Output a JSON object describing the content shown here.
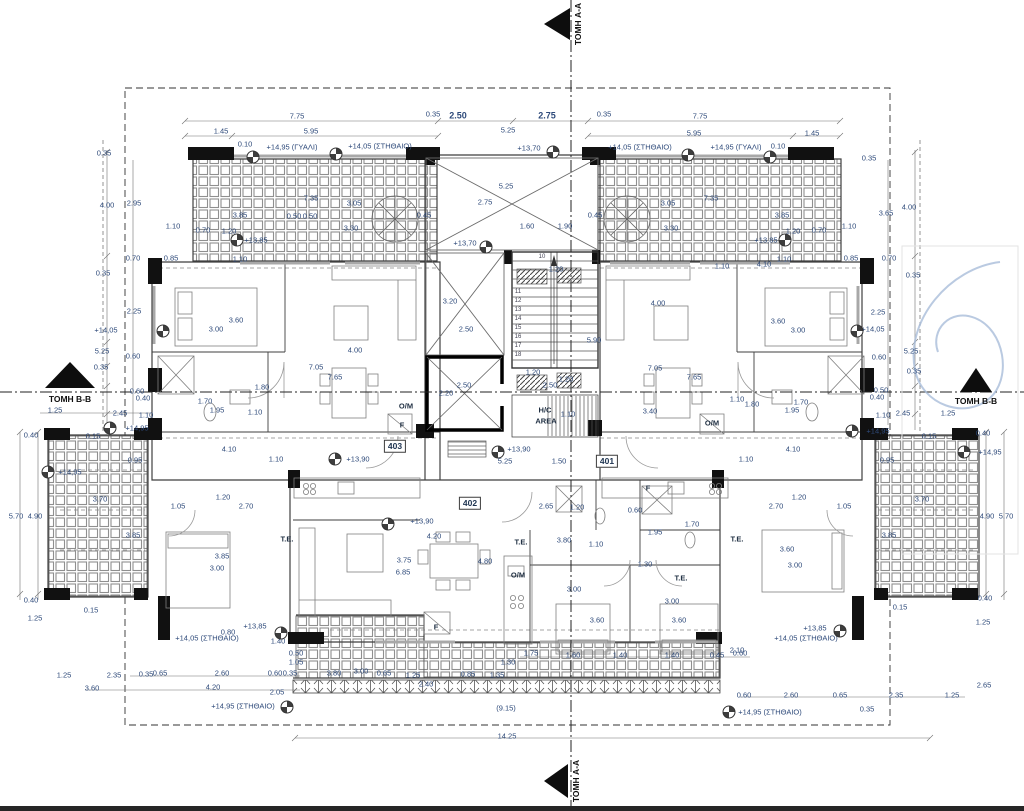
{
  "section_markers": {
    "top": "ΤΟΜΗ A-A",
    "bottom": "ΤΟΜΗ A-A",
    "left": "ΤΟΜΗ B-B",
    "right": "ΤΟΜΗ B-B"
  },
  "apartment_numbers": [
    {
      "t": "403",
      "x": 395,
      "y": 446
    },
    {
      "t": "401",
      "x": 607,
      "y": 461
    },
    {
      "t": "402",
      "x": 470,
      "y": 503
    }
  ],
  "room_labels": [
    {
      "t": "O/M",
      "x": 406,
      "y": 406
    },
    {
      "t": "F",
      "x": 402,
      "y": 425
    },
    {
      "t": "O/M",
      "x": 712,
      "y": 423
    },
    {
      "t": "F",
      "x": 648,
      "y": 488
    },
    {
      "t": "O/M",
      "x": 518,
      "y": 575
    },
    {
      "t": "F",
      "x": 436,
      "y": 627
    },
    {
      "t": "T.E.",
      "x": 287,
      "y": 539
    },
    {
      "t": "T.E.",
      "x": 521,
      "y": 542
    },
    {
      "t": "T.E.",
      "x": 681,
      "y": 578
    },
    {
      "t": "T.E.",
      "x": 737,
      "y": 539
    },
    {
      "t": "H/C",
      "x": 545,
      "y": 410
    },
    {
      "t": "AREA",
      "x": 546,
      "y": 421
    }
  ],
  "stair_step_numbers": [
    {
      "t": "10",
      "x": 542,
      "y": 257
    },
    {
      "t": "11",
      "x": 518,
      "y": 292
    },
    {
      "t": "12",
      "x": 518,
      "y": 301
    },
    {
      "t": "13",
      "x": 518,
      "y": 310
    },
    {
      "t": "14",
      "x": 518,
      "y": 319
    },
    {
      "t": "15",
      "x": 518,
      "y": 328
    },
    {
      "t": "16",
      "x": 518,
      "y": 337
    },
    {
      "t": "17",
      "x": 518,
      "y": 346
    },
    {
      "t": "18",
      "x": 518,
      "y": 355
    }
  ],
  "elevation_marks": [
    {
      "t": "+14,95 (ΓΥΑΛΙ)",
      "x": 292,
      "y": 147
    },
    {
      "t": "+14,05 (ΣΤΗΘΑΙΟ)",
      "x": 380,
      "y": 146
    },
    {
      "t": "+14,05 (ΣΤΗΘΑΙΟ)",
      "x": 640,
      "y": 147
    },
    {
      "t": "+14,95 (ΓΥΑΛΙ)",
      "x": 736,
      "y": 147
    },
    {
      "t": "+13,70",
      "x": 529,
      "y": 148
    },
    {
      "t": "+13,70",
      "x": 465,
      "y": 243
    },
    {
      "t": "+13,85",
      "x": 256,
      "y": 240
    },
    {
      "t": "+13,85",
      "x": 766,
      "y": 240
    },
    {
      "t": "+14,05",
      "x": 106,
      "y": 330
    },
    {
      "t": "+14,05",
      "x": 873,
      "y": 329
    },
    {
      "t": "+14,95",
      "x": 137,
      "y": 428
    },
    {
      "t": "+14,95",
      "x": 878,
      "y": 431
    },
    {
      "t": "+14,95",
      "x": 70,
      "y": 472
    },
    {
      "t": "+14,95",
      "x": 990,
      "y": 452
    },
    {
      "t": "+13,90",
      "x": 358,
      "y": 459
    },
    {
      "t": "+13,90",
      "x": 519,
      "y": 449
    },
    {
      "t": "+13,90",
      "x": 422,
      "y": 521
    },
    {
      "t": "+13,85",
      "x": 255,
      "y": 626
    },
    {
      "t": "+14,05 (ΣΤΗΘΑΙΟ)",
      "x": 207,
      "y": 638
    },
    {
      "t": "+13,85",
      "x": 815,
      "y": 628
    },
    {
      "t": "+14,05 (ΣΤΗΘΑΙΟ)",
      "x": 806,
      "y": 638
    },
    {
      "t": "+14,95 (ΣΤΗΘΑΙΟ)",
      "x": 243,
      "y": 706
    },
    {
      "t": "+14,95 (ΣΤΗΘΑΙΟ)",
      "x": 770,
      "y": 712
    }
  ],
  "elevation_symbols": [
    {
      "x": 253,
      "y": 157
    },
    {
      "x": 336,
      "y": 154
    },
    {
      "x": 688,
      "y": 155
    },
    {
      "x": 770,
      "y": 157
    },
    {
      "x": 553,
      "y": 152
    },
    {
      "x": 486,
      "y": 247
    },
    {
      "x": 237,
      "y": 240
    },
    {
      "x": 785,
      "y": 240
    },
    {
      "x": 163,
      "y": 331
    },
    {
      "x": 857,
      "y": 331
    },
    {
      "x": 110,
      "y": 428
    },
    {
      "x": 852,
      "y": 431
    },
    {
      "x": 48,
      "y": 472
    },
    {
      "x": 964,
      "y": 452
    },
    {
      "x": 335,
      "y": 459
    },
    {
      "x": 498,
      "y": 452
    },
    {
      "x": 388,
      "y": 524
    },
    {
      "x": 281,
      "y": 633
    },
    {
      "x": 840,
      "y": 631
    },
    {
      "x": 287,
      "y": 707
    },
    {
      "x": 729,
      "y": 712
    }
  ],
  "dimensions": [
    {
      "t": "7.75",
      "x": 297,
      "y": 116
    },
    {
      "t": "1.45",
      "x": 221,
      "y": 131
    },
    {
      "t": "5.95",
      "x": 311,
      "y": 131
    },
    {
      "t": "0.10",
      "x": 245,
      "y": 144
    },
    {
      "t": "0.35",
      "x": 433,
      "y": 114
    },
    {
      "t": "2.50",
      "x": 458,
      "y": 116,
      "b": 1
    },
    {
      "t": "2.75",
      "x": 547,
      "y": 116,
      "b": 1
    },
    {
      "t": "0.35",
      "x": 604,
      "y": 114
    },
    {
      "t": "5.25",
      "x": 508,
      "y": 130
    },
    {
      "t": "7.75",
      "x": 700,
      "y": 116
    },
    {
      "t": "5.95",
      "x": 694,
      "y": 133
    },
    {
      "t": "1.45",
      "x": 812,
      "y": 133
    },
    {
      "t": "0.10",
      "x": 778,
      "y": 146
    },
    {
      "t": "5.25",
      "x": 506,
      "y": 186
    },
    {
      "t": "2.75",
      "x": 485,
      "y": 202
    },
    {
      "t": "1.60",
      "x": 527,
      "y": 226
    },
    {
      "t": "1.90",
      "x": 565,
      "y": 226
    },
    {
      "t": "0.45",
      "x": 424,
      "y": 215
    },
    {
      "t": "0.45",
      "x": 595,
      "y": 215
    },
    {
      "t": "7.35",
      "x": 311,
      "y": 198
    },
    {
      "t": "3.05",
      "x": 354,
      "y": 203
    },
    {
      "t": "3.85",
      "x": 240,
      "y": 215
    },
    {
      "t": "0.50",
      "x": 294,
      "y": 216
    },
    {
      "t": "0.50",
      "x": 310,
      "y": 216
    },
    {
      "t": "3.30",
      "x": 351,
      "y": 228
    },
    {
      "t": "0.70",
      "x": 203,
      "y": 230
    },
    {
      "t": "1.20",
      "x": 229,
      "y": 231
    },
    {
      "t": "1.10",
      "x": 240,
      "y": 259
    },
    {
      "t": "7.35",
      "x": 711,
      "y": 198
    },
    {
      "t": "3.05",
      "x": 668,
      "y": 203
    },
    {
      "t": "3.85",
      "x": 782,
      "y": 215
    },
    {
      "t": "3.30",
      "x": 671,
      "y": 228
    },
    {
      "t": "0.70",
      "x": 819,
      "y": 230
    },
    {
      "t": "1.20",
      "x": 793,
      "y": 231
    },
    {
      "t": "1.10",
      "x": 784,
      "y": 259
    },
    {
      "t": "0.35",
      "x": 104,
      "y": 153
    },
    {
      "t": "4.00",
      "x": 107,
      "y": 205
    },
    {
      "t": "2.95",
      "x": 134,
      "y": 203
    },
    {
      "t": "1.10",
      "x": 173,
      "y": 226
    },
    {
      "t": "0.70",
      "x": 133,
      "y": 258
    },
    {
      "t": "0.85",
      "x": 171,
      "y": 258
    },
    {
      "t": "0.35",
      "x": 103,
      "y": 273
    },
    {
      "t": "2.25",
      "x": 134,
      "y": 311
    },
    {
      "t": "5.25",
      "x": 102,
      "y": 351
    },
    {
      "t": "0.60",
      "x": 133,
      "y": 356
    },
    {
      "t": "0.35",
      "x": 101,
      "y": 367
    },
    {
      "t": "0.60",
      "x": 137,
      "y": 391
    },
    {
      "t": "0.40",
      "x": 143,
      "y": 398
    },
    {
      "t": "1.25",
      "x": 55,
      "y": 410
    },
    {
      "t": "2.45",
      "x": 120,
      "y": 413
    },
    {
      "t": "1.10",
      "x": 146,
      "y": 415
    },
    {
      "t": "0.35",
      "x": 869,
      "y": 158
    },
    {
      "t": "4.00",
      "x": 909,
      "y": 207
    },
    {
      "t": "3.65",
      "x": 886,
      "y": 213
    },
    {
      "t": "1.10",
      "x": 849,
      "y": 226
    },
    {
      "t": "0.85",
      "x": 851,
      "y": 258
    },
    {
      "t": "0.70",
      "x": 889,
      "y": 258
    },
    {
      "t": "0.35",
      "x": 913,
      "y": 275
    },
    {
      "t": "2.25",
      "x": 878,
      "y": 312
    },
    {
      "t": "5.25",
      "x": 911,
      "y": 351
    },
    {
      "t": "0.60",
      "x": 879,
      "y": 357
    },
    {
      "t": "0.35",
      "x": 914,
      "y": 371
    },
    {
      "t": "0.50",
      "x": 881,
      "y": 390
    },
    {
      "t": "0.40",
      "x": 877,
      "y": 397
    },
    {
      "t": "2.45",
      "x": 903,
      "y": 413
    },
    {
      "t": "1.10",
      "x": 883,
      "y": 415
    },
    {
      "t": "1.25",
      "x": 948,
      "y": 413
    },
    {
      "t": "3.60",
      "x": 236,
      "y": 320
    },
    {
      "t": "3.00",
      "x": 216,
      "y": 329
    },
    {
      "t": "1.80",
      "x": 262,
      "y": 387
    },
    {
      "t": "1.70",
      "x": 205,
      "y": 401
    },
    {
      "t": "1.95",
      "x": 217,
      "y": 410
    },
    {
      "t": "1.10",
      "x": 255,
      "y": 412
    },
    {
      "t": "4.00",
      "x": 355,
      "y": 350
    },
    {
      "t": "7.05",
      "x": 316,
      "y": 367
    },
    {
      "t": "7.65",
      "x": 335,
      "y": 377
    },
    {
      "t": "4.10",
      "x": 229,
      "y": 449
    },
    {
      "t": "1.10",
      "x": 276,
      "y": 459
    },
    {
      "t": "1.20",
      "x": 223,
      "y": 497
    },
    {
      "t": "1.05",
      "x": 178,
      "y": 506
    },
    {
      "t": "2.70",
      "x": 246,
      "y": 506
    },
    {
      "t": "3.85",
      "x": 222,
      "y": 556
    },
    {
      "t": "3.00",
      "x": 217,
      "y": 568
    },
    {
      "t": "3.60",
      "x": 778,
      "y": 321
    },
    {
      "t": "3.00",
      "x": 798,
      "y": 330
    },
    {
      "t": "4.00",
      "x": 658,
      "y": 303
    },
    {
      "t": "7.05",
      "x": 655,
      "y": 368
    },
    {
      "t": "7.65",
      "x": 694,
      "y": 377
    },
    {
      "t": "3.40",
      "x": 650,
      "y": 411
    },
    {
      "t": "1.10",
      "x": 737,
      "y": 399
    },
    {
      "t": "1.80",
      "x": 752,
      "y": 404
    },
    {
      "t": "1.70",
      "x": 801,
      "y": 402
    },
    {
      "t": "1.95",
      "x": 792,
      "y": 410
    },
    {
      "t": "4.10",
      "x": 793,
      "y": 449
    },
    {
      "t": "1.10",
      "x": 746,
      "y": 459
    },
    {
      "t": "1.20",
      "x": 799,
      "y": 497
    },
    {
      "t": "1.05",
      "x": 844,
      "y": 506
    },
    {
      "t": "2.70",
      "x": 776,
      "y": 506
    },
    {
      "t": "3.60",
      "x": 787,
      "y": 549
    },
    {
      "t": "3.00",
      "x": 795,
      "y": 565
    },
    {
      "t": "1.10",
      "x": 722,
      "y": 266
    },
    {
      "t": "4.10",
      "x": 764,
      "y": 264
    },
    {
      "t": "3.20",
      "x": 450,
      "y": 301
    },
    {
      "t": "2.50",
      "x": 466,
      "y": 329
    },
    {
      "t": "2.50",
      "x": 464,
      "y": 385
    },
    {
      "t": "2.20",
      "x": 446,
      "y": 393
    },
    {
      "t": "1.20",
      "x": 556,
      "y": 269
    },
    {
      "t": "1.20",
      "x": 533,
      "y": 372
    },
    {
      "t": "1.20",
      "x": 566,
      "y": 379
    },
    {
      "t": "5.90",
      "x": 594,
      "y": 340
    },
    {
      "t": "2.50",
      "x": 550,
      "y": 385
    },
    {
      "t": "1.10",
      "x": 568,
      "y": 414
    },
    {
      "t": "5.25",
      "x": 505,
      "y": 461
    },
    {
      "t": "1.50",
      "x": 559,
      "y": 461
    },
    {
      "t": "2.65",
      "x": 546,
      "y": 506
    },
    {
      "t": "1.20",
      "x": 577,
      "y": 507
    },
    {
      "t": "0.60",
      "x": 635,
      "y": 510
    },
    {
      "t": "1.70",
      "x": 692,
      "y": 524
    },
    {
      "t": "1.95",
      "x": 655,
      "y": 532
    },
    {
      "t": "3.80",
      "x": 564,
      "y": 540
    },
    {
      "t": "1.10",
      "x": 596,
      "y": 544
    },
    {
      "t": "1.30",
      "x": 645,
      "y": 564
    },
    {
      "t": "3.00",
      "x": 574,
      "y": 589
    },
    {
      "t": "3.00",
      "x": 672,
      "y": 601
    },
    {
      "t": "3.60",
      "x": 597,
      "y": 620
    },
    {
      "t": "3.60",
      "x": 679,
      "y": 620
    },
    {
      "t": "4.20",
      "x": 434,
      "y": 536
    },
    {
      "t": "3.75",
      "x": 404,
      "y": 560
    },
    {
      "t": "4.80",
      "x": 485,
      "y": 561
    },
    {
      "t": "6.85",
      "x": 403,
      "y": 572
    },
    {
      "t": "0.40",
      "x": 31,
      "y": 435
    },
    {
      "t": "0.15",
      "x": 93,
      "y": 436
    },
    {
      "t": "0.95",
      "x": 135,
      "y": 460
    },
    {
      "t": "3.70",
      "x": 100,
      "y": 499
    },
    {
      "t": "5.70",
      "x": 16,
      "y": 516
    },
    {
      "t": "4.90",
      "x": 35,
      "y": 516
    },
    {
      "t": "3.85",
      "x": 133,
      "y": 535
    },
    {
      "t": "0.40",
      "x": 31,
      "y": 600
    },
    {
      "t": "0.15",
      "x": 91,
      "y": 610
    },
    {
      "t": "1.25",
      "x": 35,
      "y": 618
    },
    {
      "t": "1.25",
      "x": 64,
      "y": 675
    },
    {
      "t": "2.35",
      "x": 114,
      "y": 675
    },
    {
      "t": "0.35",
      "x": 146,
      "y": 674
    },
    {
      "t": "3.60",
      "x": 92,
      "y": 688
    },
    {
      "t": "0.40",
      "x": 983,
      "y": 433
    },
    {
      "t": "0.15",
      "x": 929,
      "y": 436
    },
    {
      "t": "0.95",
      "x": 887,
      "y": 460
    },
    {
      "t": "3.70",
      "x": 922,
      "y": 499
    },
    {
      "t": "4.90",
      "x": 987,
      "y": 516
    },
    {
      "t": "5.70",
      "x": 1006,
      "y": 516
    },
    {
      "t": "3.85",
      "x": 889,
      "y": 535
    },
    {
      "t": "0.40",
      "x": 985,
      "y": 598
    },
    {
      "t": "0.15",
      "x": 900,
      "y": 607
    },
    {
      "t": "1.25",
      "x": 983,
      "y": 622
    },
    {
      "t": "2.65",
      "x": 984,
      "y": 685
    },
    {
      "t": "2.10",
      "x": 737,
      "y": 650
    },
    {
      "t": "0.65",
      "x": 160,
      "y": 673
    },
    {
      "t": "2.60",
      "x": 222,
      "y": 673
    },
    {
      "t": "0.60",
      "x": 275,
      "y": 673
    },
    {
      "t": "0.35",
      "x": 290,
      "y": 673
    },
    {
      "t": "4.20",
      "x": 213,
      "y": 687
    },
    {
      "t": "2.05",
      "x": 277,
      "y": 692
    },
    {
      "t": "0.80",
      "x": 228,
      "y": 632
    },
    {
      "t": "1.40",
      "x": 278,
      "y": 641
    },
    {
      "t": "0.50",
      "x": 296,
      "y": 653
    },
    {
      "t": "1.05",
      "x": 296,
      "y": 662
    },
    {
      "t": "3.80",
      "x": 334,
      "y": 673
    },
    {
      "t": "3.00",
      "x": 361,
      "y": 671
    },
    {
      "t": "0.65",
      "x": 384,
      "y": 673
    },
    {
      "t": "1.25",
      "x": 413,
      "y": 675
    },
    {
      "t": "2.40",
      "x": 426,
      "y": 684
    },
    {
      "t": "0.85",
      "x": 468,
      "y": 674
    },
    {
      "t": "1.35",
      "x": 497,
      "y": 675
    },
    {
      "t": "1.30",
      "x": 508,
      "y": 662
    },
    {
      "t": "1.75",
      "x": 531,
      "y": 653
    },
    {
      "t": "1.60",
      "x": 573,
      "y": 655
    },
    {
      "t": "1.40",
      "x": 620,
      "y": 655
    },
    {
      "t": "1.40",
      "x": 672,
      "y": 655
    },
    {
      "t": "0.45",
      "x": 717,
      "y": 655
    },
    {
      "t": "0.60",
      "x": 740,
      "y": 653
    },
    {
      "t": "(9.15)",
      "x": 506,
      "y": 708
    },
    {
      "t": "14.25",
      "x": 507,
      "y": 736
    },
    {
      "t": "0.60",
      "x": 744,
      "y": 695
    },
    {
      "t": "2.60",
      "x": 791,
      "y": 695
    },
    {
      "t": "0.65",
      "x": 840,
      "y": 695
    },
    {
      "t": "2.35",
      "x": 896,
      "y": 695
    },
    {
      "t": "1.25",
      "x": 952,
      "y": 695
    },
    {
      "t": "0.35",
      "x": 867,
      "y": 709
    }
  ],
  "colors": {
    "dimension_text": "#2e4a7a",
    "line": "#3a3a3a",
    "pen_annotation": "#a9bdd9"
  }
}
